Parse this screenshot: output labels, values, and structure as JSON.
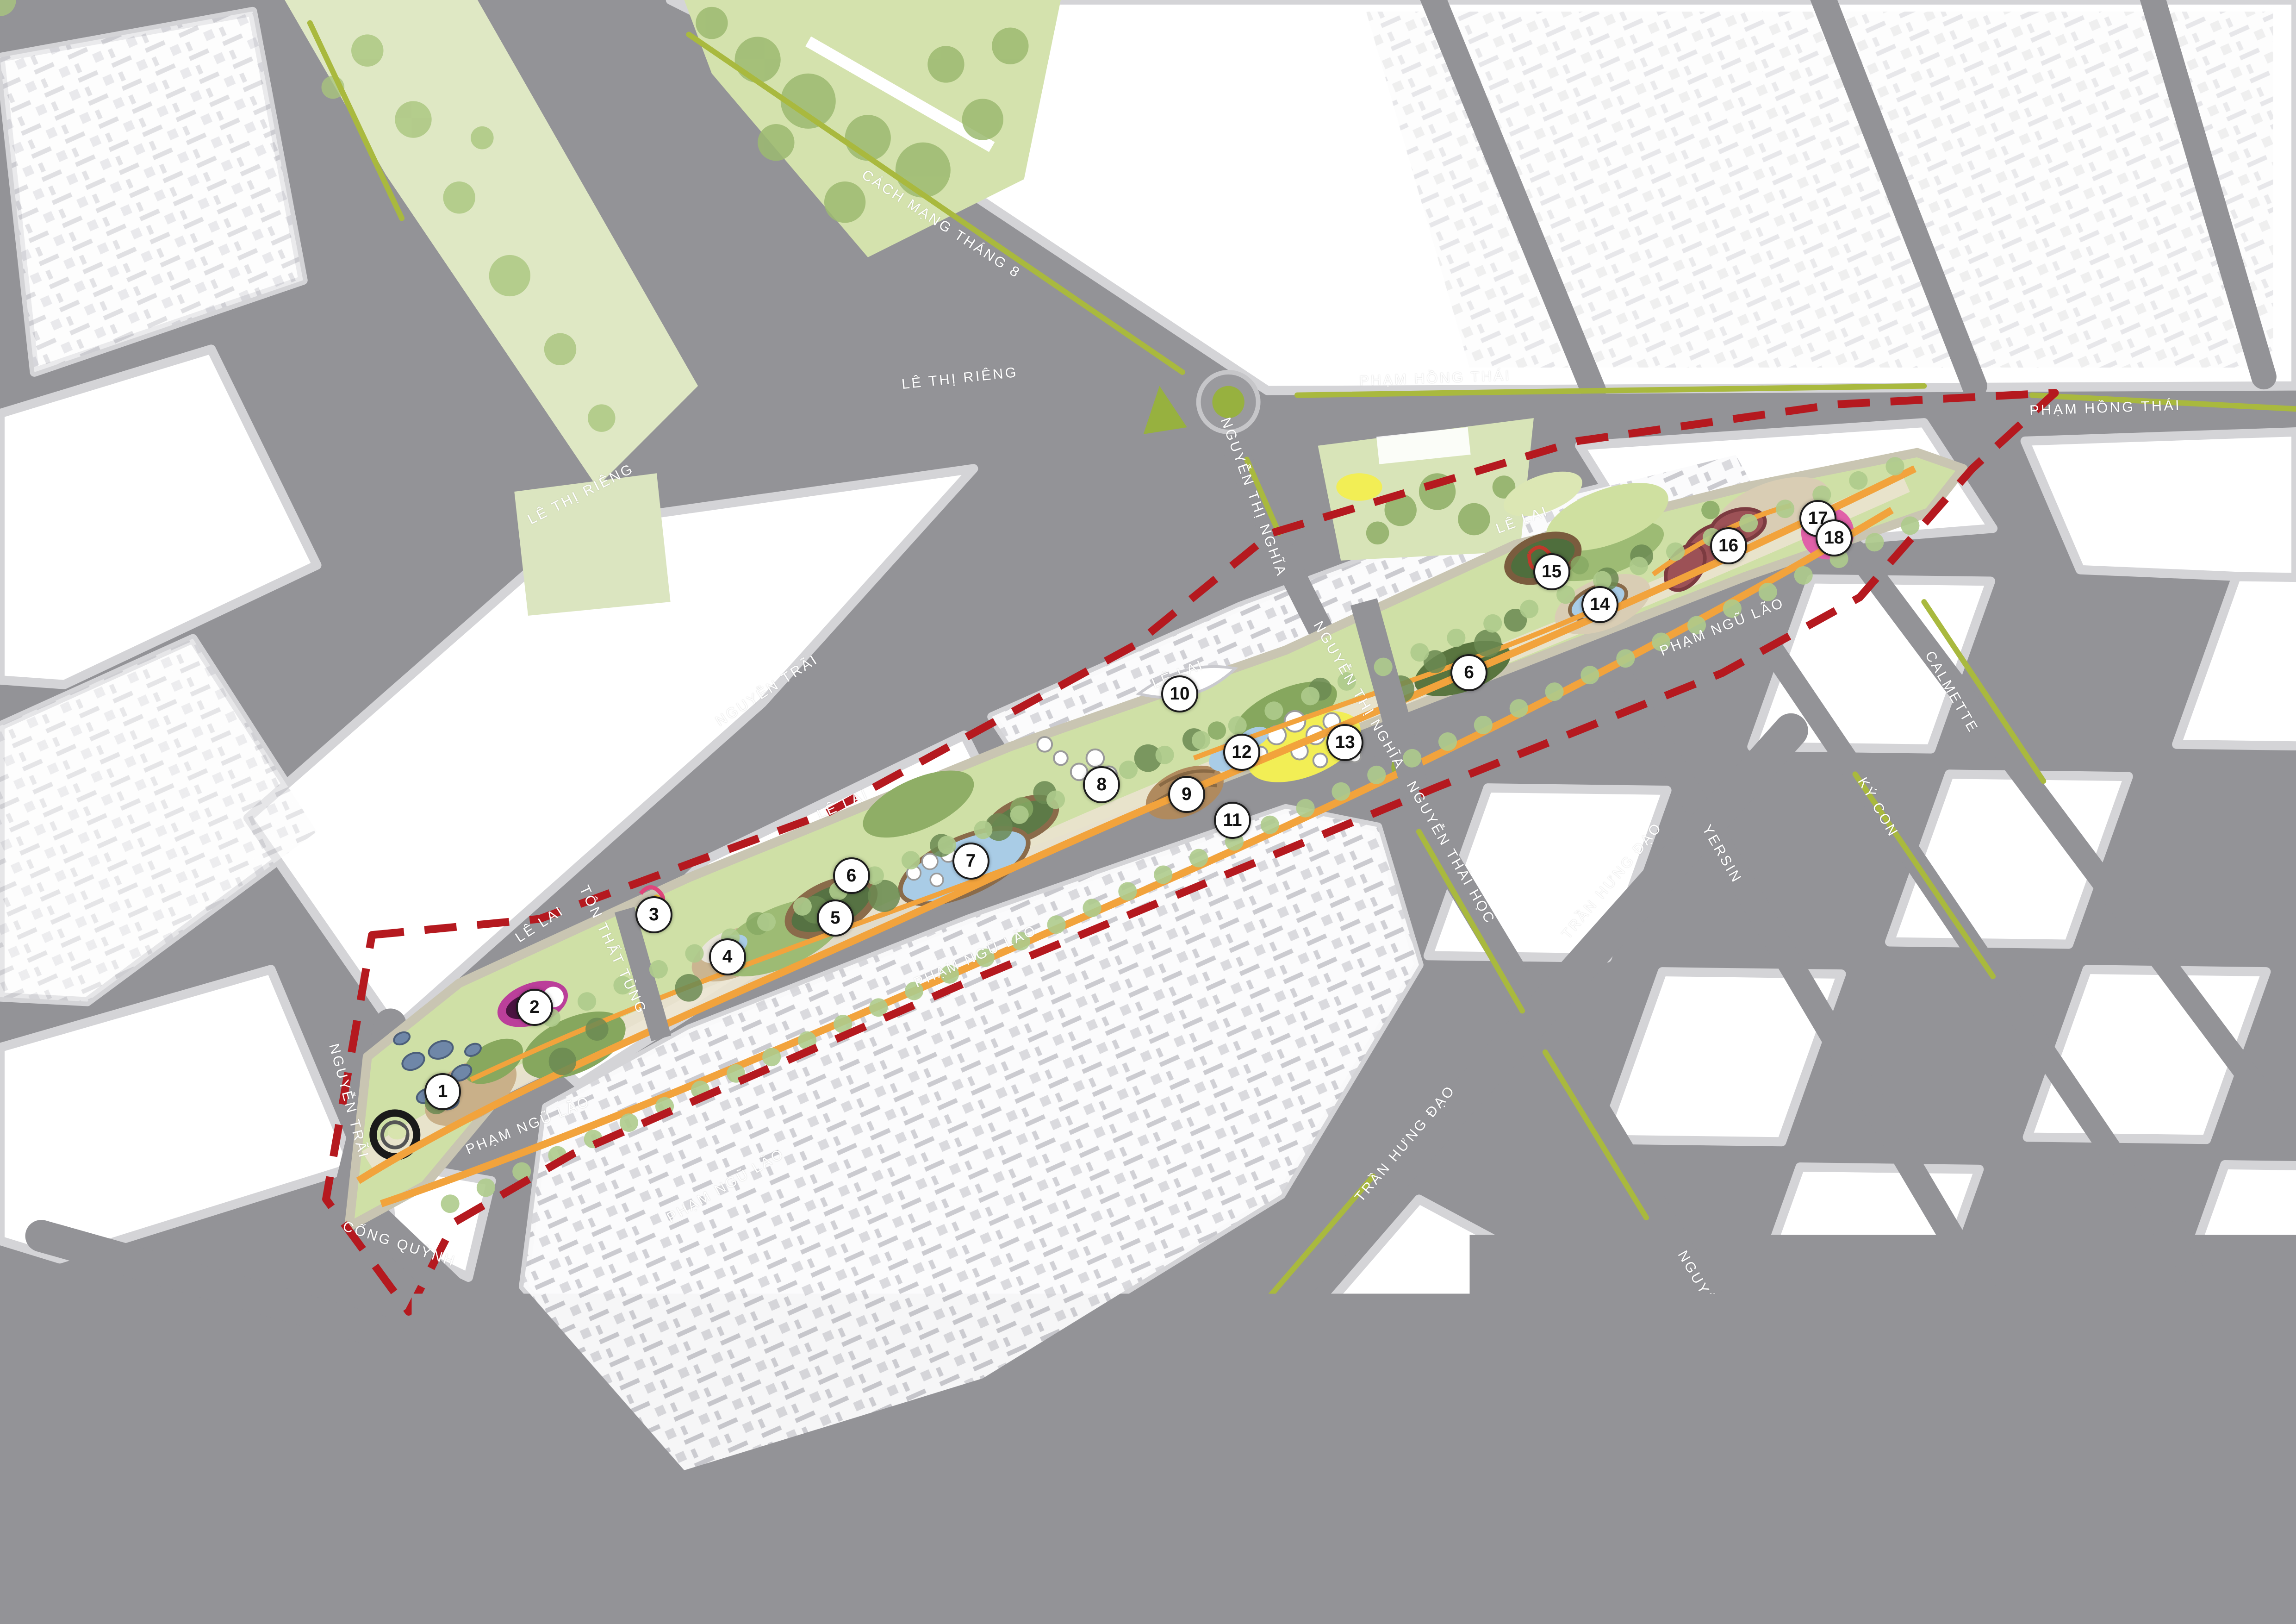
{
  "map": {
    "type": "urban-masterplan-site-plan",
    "boundary_style": "red-dashed",
    "marker_count": 18
  },
  "colors": {
    "road_gray": "#939397",
    "sidewalk_gray": "#d4d4d7",
    "block_white": "#ffffff",
    "building_shadow": "#c9c9ce",
    "park_green": "#cfe0a6",
    "lawn_dark_green": "#86a75e",
    "tree_green": "#6b8a52",
    "street_tree_green": "#aecb8c",
    "water_blue": "#a9cce6",
    "path_orange": "#f2a33c",
    "median_olive": "#a9b93e",
    "boundary_red": "#b5191f",
    "plaza_yellow": "#f2ee55",
    "plaza_tan": "#c9b089",
    "feature_magenta": "#bb3f9a",
    "feature_maroon": "#9c5156",
    "feature_pink": "#e060a8",
    "roundabout_green": "#97b13f",
    "label_white": "#ffffff"
  },
  "street_labels": [
    {
      "text": "CÁCH MẠNG THÁNG 8",
      "x": 41.0,
      "y": 13.8,
      "rot": 33
    },
    {
      "text": "LÊ THỊ RIÊNG",
      "x": 41.8,
      "y": 23.3,
      "rot": -6
    },
    {
      "text": "PHẠM HỒNG THÁI",
      "x": 62.5,
      "y": 23.3,
      "rot": -2
    },
    {
      "text": "PHẠM HỒNG THÁI",
      "x": 91.7,
      "y": 25.1,
      "rot": -2
    },
    {
      "text": "LÊ THỊ RIÊNG",
      "x": 25.3,
      "y": 30.4,
      "rot": -27
    },
    {
      "text": "NGUYỄN THỊ NGHĨA",
      "x": 54.6,
      "y": 30.6,
      "rot": 70
    },
    {
      "text": "NGUYỄN THỊ NGHĨA",
      "x": 59.2,
      "y": 42.8,
      "rot": 60
    },
    {
      "text": "NGUYỄN TRÃI",
      "x": 33.4,
      "y": 42.5,
      "rot": -33
    },
    {
      "text": "LÊ LAI",
      "x": 23.5,
      "y": 56.9,
      "rot": -33
    },
    {
      "text": "LÊ LAI",
      "x": 36.7,
      "y": 49.5,
      "rot": -24
    },
    {
      "text": "LÊ LAI",
      "x": 51.3,
      "y": 41.5,
      "rot": -22
    },
    {
      "text": "LÊ LAI",
      "x": 66.3,
      "y": 32.0,
      "rot": -20
    },
    {
      "text": "TÔN THẤT TÙNG",
      "x": 26.7,
      "y": 58.5,
      "rot": 65
    },
    {
      "text": "NGUYỄN TRÃI",
      "x": 15.2,
      "y": 67.8,
      "rot": 75
    },
    {
      "text": "PHẠM NGŨ LÃO",
      "x": 23.0,
      "y": 69.3,
      "rot": -22
    },
    {
      "text": "PHẠM NGŨ LÃO",
      "x": 31.6,
      "y": 73.0,
      "rot": -30
    },
    {
      "text": "PHẠM NGŨ LÃO",
      "x": 42.5,
      "y": 58.9,
      "rot": -24
    },
    {
      "text": "PHẠM NGŨ LÃO",
      "x": 75.0,
      "y": 38.6,
      "rot": -22
    },
    {
      "text": "CỐNG QUỲNH",
      "x": 17.4,
      "y": 76.6,
      "rot": 18
    },
    {
      "text": "NGUYỄN THÁI HỌC",
      "x": 63.2,
      "y": 52.5,
      "rot": 60
    },
    {
      "text": "TRẦN HƯNG ĐẠO",
      "x": 70.2,
      "y": 54.2,
      "rot": -50
    },
    {
      "text": "YERSIN",
      "x": 75.0,
      "y": 52.6,
      "rot": 60
    },
    {
      "text": "KÝ CON",
      "x": 81.8,
      "y": 49.7,
      "rot": 60
    },
    {
      "text": "CALMETTE",
      "x": 85.0,
      "y": 42.6,
      "rot": 60
    },
    {
      "text": "TRẦN HƯNG ĐẠO",
      "x": 61.2,
      "y": 70.4,
      "rot": -50
    },
    {
      "text": "NGUYỄN THÁI HỌC",
      "x": 75.0,
      "y": 81.4,
      "rot": 60
    },
    {
      "text": "YERSIN",
      "x": 88.6,
      "y": 85.7,
      "rot": 60
    }
  ],
  "markers": [
    {
      "n": "1",
      "x": 19.2,
      "y": 67.1
    },
    {
      "n": "2",
      "x": 23.2,
      "y": 61.9
    },
    {
      "n": "3",
      "x": 28.4,
      "y": 56.2
    },
    {
      "n": "4",
      "x": 31.6,
      "y": 58.8
    },
    {
      "n": "5",
      "x": 36.3,
      "y": 56.4
    },
    {
      "n": "6",
      "x": 37.0,
      "y": 53.8
    },
    {
      "n": "7",
      "x": 42.2,
      "y": 52.9
    },
    {
      "n": "8",
      "x": 47.9,
      "y": 48.2
    },
    {
      "n": "9",
      "x": 51.6,
      "y": 48.8
    },
    {
      "n": "10",
      "x": 51.3,
      "y": 42.6
    },
    {
      "n": "11",
      "x": 53.6,
      "y": 50.4
    },
    {
      "n": "12",
      "x": 54.0,
      "y": 46.2
    },
    {
      "n": "13",
      "x": 58.5,
      "y": 45.6
    },
    {
      "n": "6",
      "x": 63.9,
      "y": 41.3
    },
    {
      "n": "14",
      "x": 69.6,
      "y": 37.1
    },
    {
      "n": "15",
      "x": 67.5,
      "y": 35.1
    },
    {
      "n": "16",
      "x": 75.2,
      "y": 33.5
    },
    {
      "n": "17",
      "x": 79.1,
      "y": 31.8
    },
    {
      "n": "18",
      "x": 79.8,
      "y": 33.0
    }
  ]
}
